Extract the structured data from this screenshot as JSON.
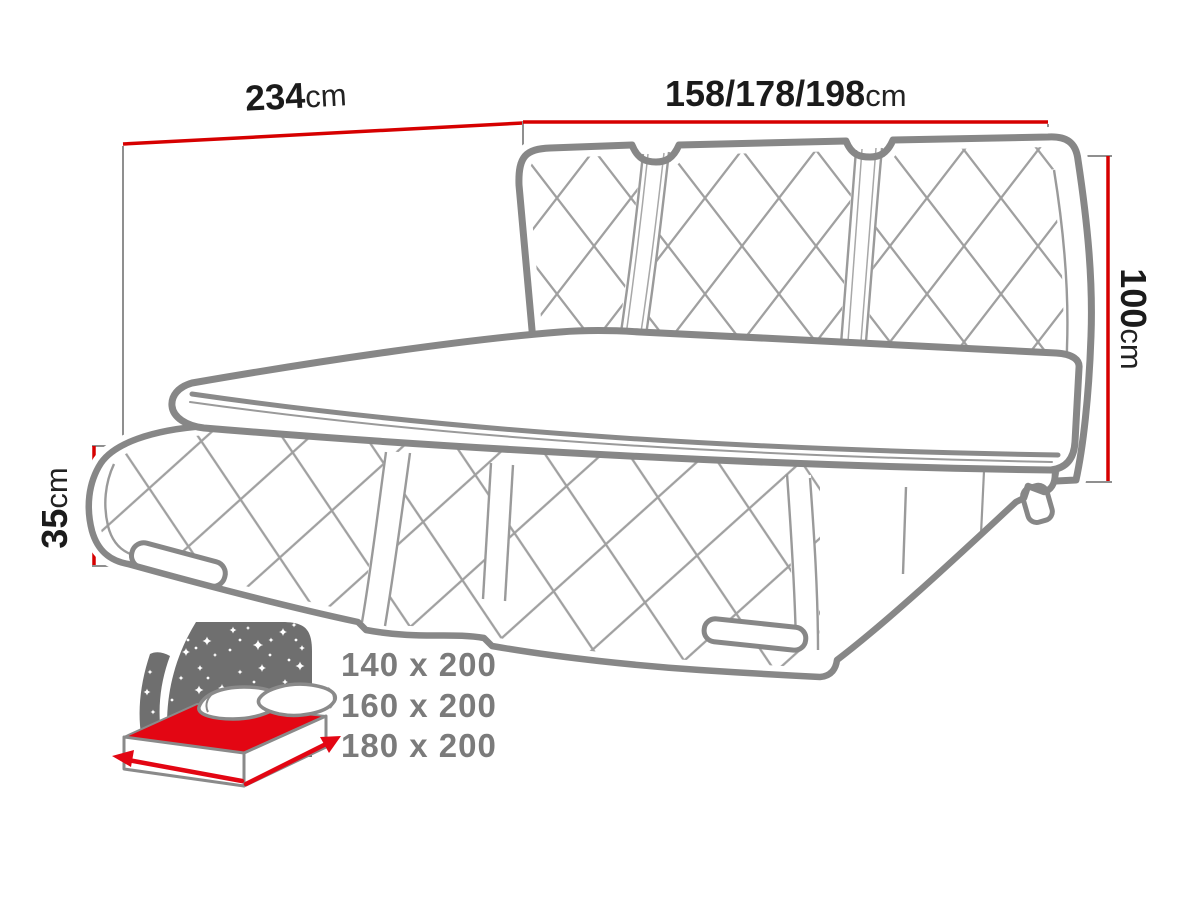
{
  "diagram": {
    "title": "upholstered-bed-dimension-diagram",
    "dimensions": {
      "bed_width": {
        "value": "234",
        "unit": "cm"
      },
      "headboard_width": {
        "value": "158/178/198",
        "unit": "cm"
      },
      "headboard_height": {
        "value": "100",
        "unit": "cm"
      },
      "frame_height": {
        "value": "35",
        "unit": "cm"
      }
    },
    "mattress_sizes": [
      "140 x 200",
      "160 x 200",
      "180 x 200"
    ],
    "icons": {
      "bottom_left": "mattress-size-night-icon"
    },
    "colors": {
      "dimension_line_red": "#d60000",
      "icon_accent_red": "#e30613",
      "drawing_outline_grey": "#878787",
      "quilt_line_grey": "#a0a0a0",
      "label_text": "#1b1b1b",
      "sizes_text_grey": "#7b7b7b",
      "icon_panel_grey": "#6f6f6f",
      "background": "#ffffff"
    }
  }
}
